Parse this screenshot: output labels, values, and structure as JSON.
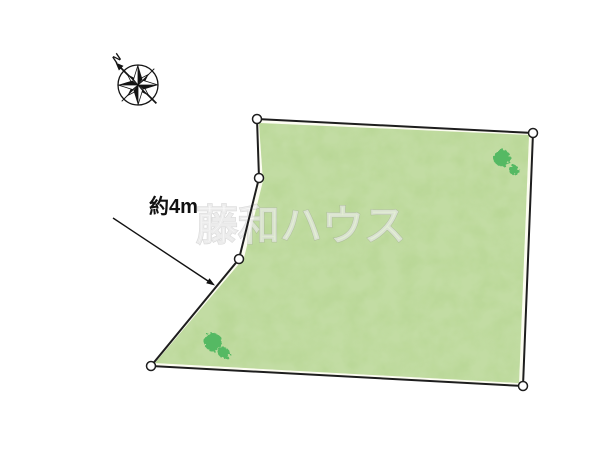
{
  "diagram": {
    "background": "#ffffff",
    "title": "land-plot-diagram"
  },
  "compass": {
    "north_label": "N"
  },
  "annotation": {
    "label": "約4m",
    "line": {
      "x1": 113,
      "y1": 218,
      "x2": 208,
      "y2": 281
    },
    "arrow_points": "215,285.5 206.2,283.3 209.5,278.3",
    "label_x": 149,
    "label_y": 213
  },
  "watermark": {
    "text": "藤和ハウス",
    "x": 301,
    "y": 240
  },
  "land": {
    "outline_points": "257,119 533,133 523,386 151,366 239,259 259,178",
    "fill_points": "259,123 529,135 519,383 155,363 244,258 263,181",
    "vertex_radius": 4.5,
    "colors": {
      "outline": "#1e1e1e",
      "border_fill": "#fcfcf1",
      "grass_base": "#b6d592",
      "tree": "#55b963",
      "vertex_fill": "#ffffff",
      "annotation_ink": "#111111"
    },
    "vertices": [
      {
        "cx": 257,
        "cy": 119
      },
      {
        "cx": 533,
        "cy": 133
      },
      {
        "cx": 523,
        "cy": 386
      },
      {
        "cx": 151,
        "cy": 366
      },
      {
        "cx": 239,
        "cy": 259
      },
      {
        "cx": 259,
        "cy": 178
      }
    ],
    "trees": [
      {
        "cx": 502,
        "cy": 158,
        "r": 8.5
      },
      {
        "cx": 514,
        "cy": 170,
        "r": 5
      },
      {
        "cx": 213,
        "cy": 342,
        "r": 9
      },
      {
        "cx": 224,
        "cy": 353,
        "r": 5.5
      }
    ]
  }
}
